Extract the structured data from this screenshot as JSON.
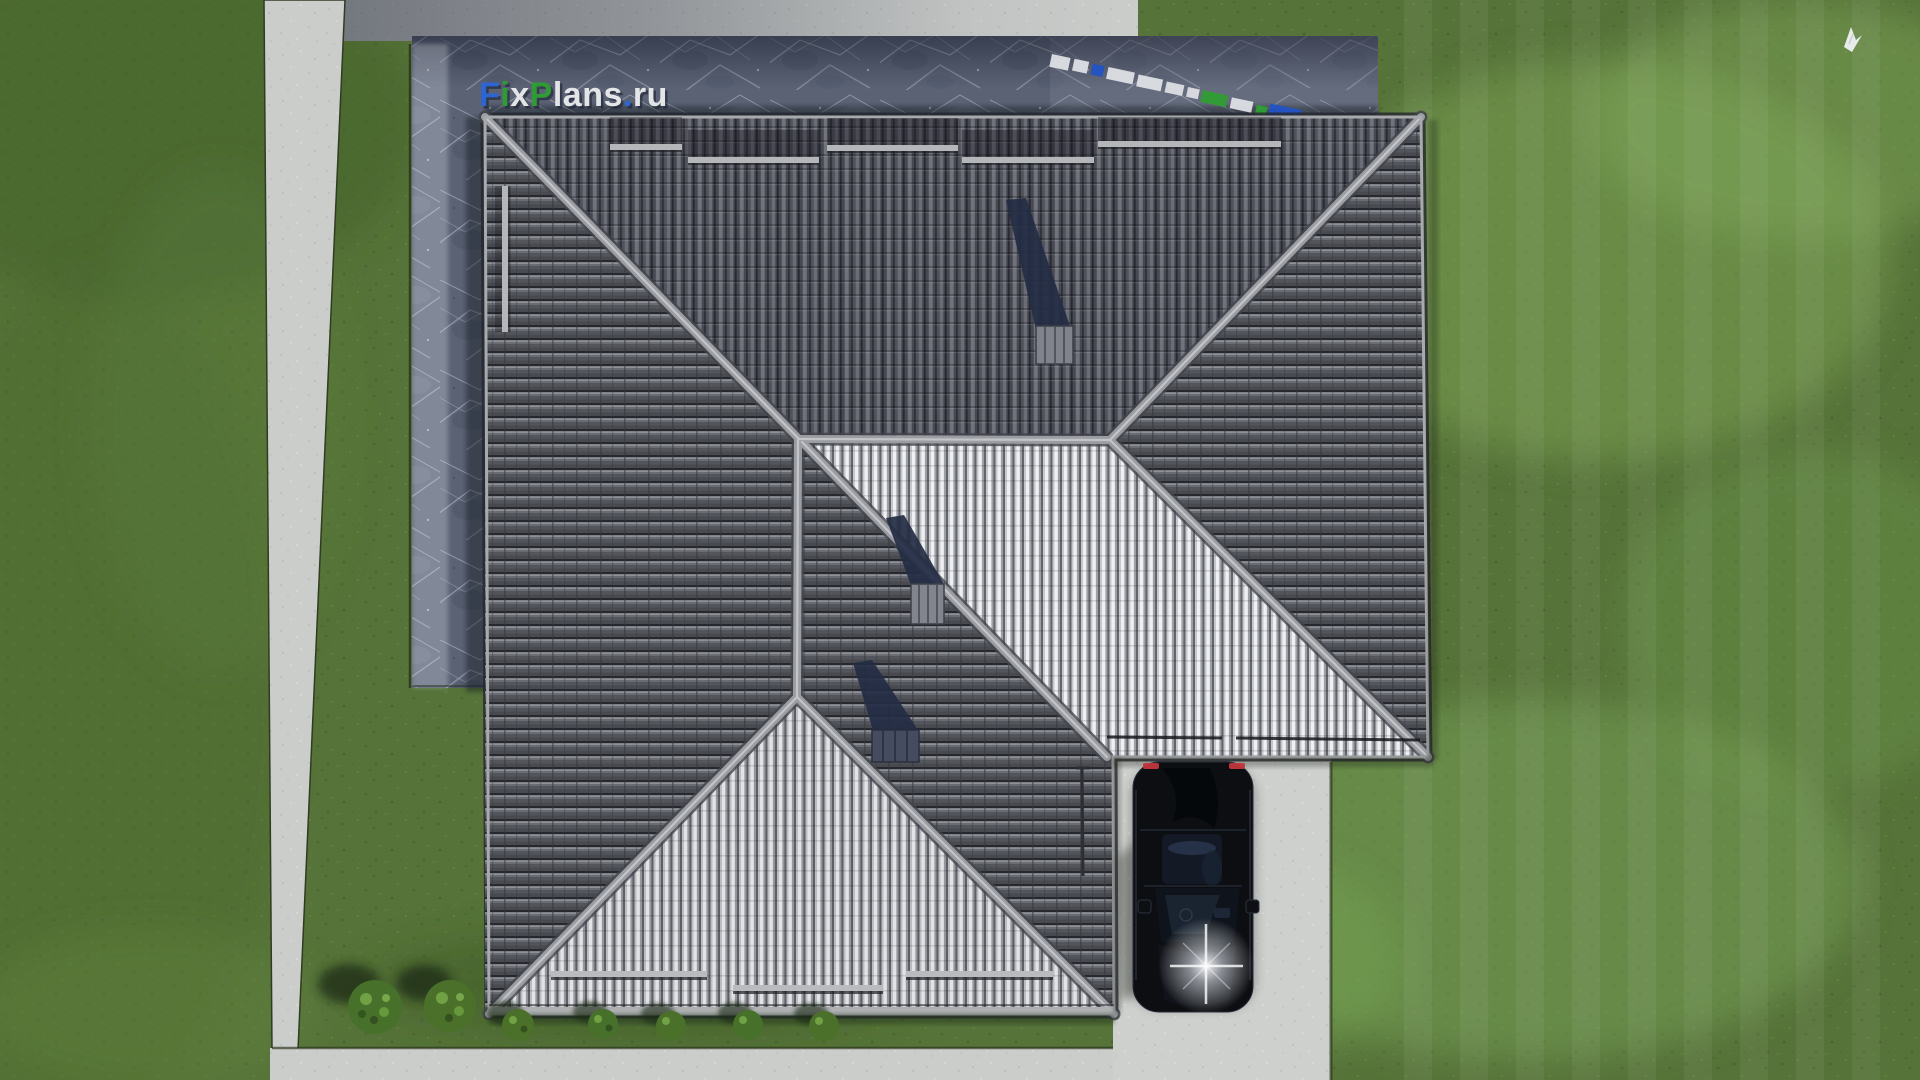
{
  "watermark": {
    "part1": "F",
    "part2": "i",
    "part3": "x",
    "part4": "P",
    "part5": "lans",
    "part6": ".",
    "part7": "ru"
  },
  "palette": {
    "grass": "#567339",
    "grass_dark": "#46602c",
    "grass_light": "#7ca455",
    "concrete": "#cbcdcb",
    "patio_stone": "#5a6274",
    "roof_dark_tile": "#53555c",
    "roof_ridge": "#9b9da2",
    "roof_light_stripe": "#eff0f2",
    "chimney_shadow": "#242c44",
    "chimney_block": "#83858e",
    "car_body": "#0c0e12",
    "taillight_red": "#c2373d",
    "headlight_glare": "#ffffff",
    "bird_white": "#eef1f4",
    "logo_blue": "#2c67d6",
    "logo_green": "#2f9e33",
    "logo_white": "#e8eaec"
  }
}
